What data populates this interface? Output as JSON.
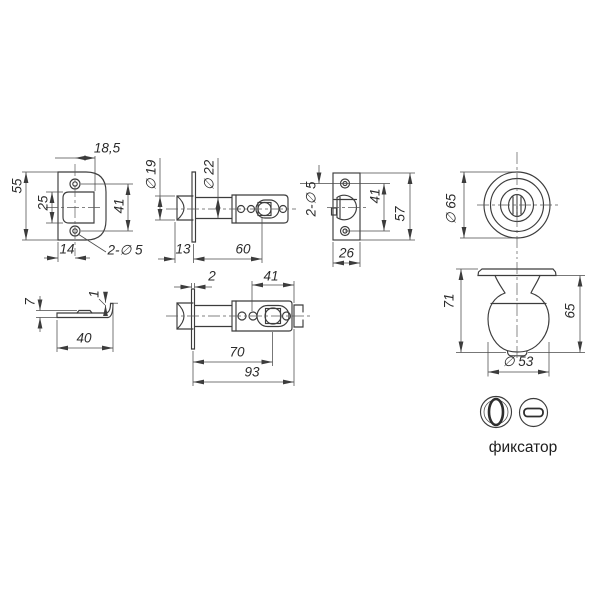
{
  "drawing": {
    "faceplate_front": {
      "top_width": "18,5",
      "height": "55",
      "cutout_height": "25",
      "hole_span": "41",
      "hole_offset": "14",
      "holes_note": "2-∅ 5"
    },
    "latch_side": {
      "head_dia": "∅ 19",
      "tube_dia": "∅ 22",
      "tip_len": "13",
      "tube_len": "60"
    },
    "strike_plate": {
      "holes_note": "2-∅ 5",
      "hole_span": "41",
      "height": "57",
      "width": "26"
    },
    "knob_front": {
      "dia": "∅ 65"
    },
    "knob_side": {
      "total_height": "71",
      "knob_height": "65",
      "knob_dia": "∅ 53"
    },
    "latch_top": {
      "plate_thickness": "2",
      "spindle_span": "41",
      "spindle_dist": "70",
      "total_len": "93"
    },
    "faceplate_edge": {
      "height": "7",
      "thickness": "1",
      "width": "40"
    },
    "legend": {
      "fixator": "фиксатор"
    }
  }
}
